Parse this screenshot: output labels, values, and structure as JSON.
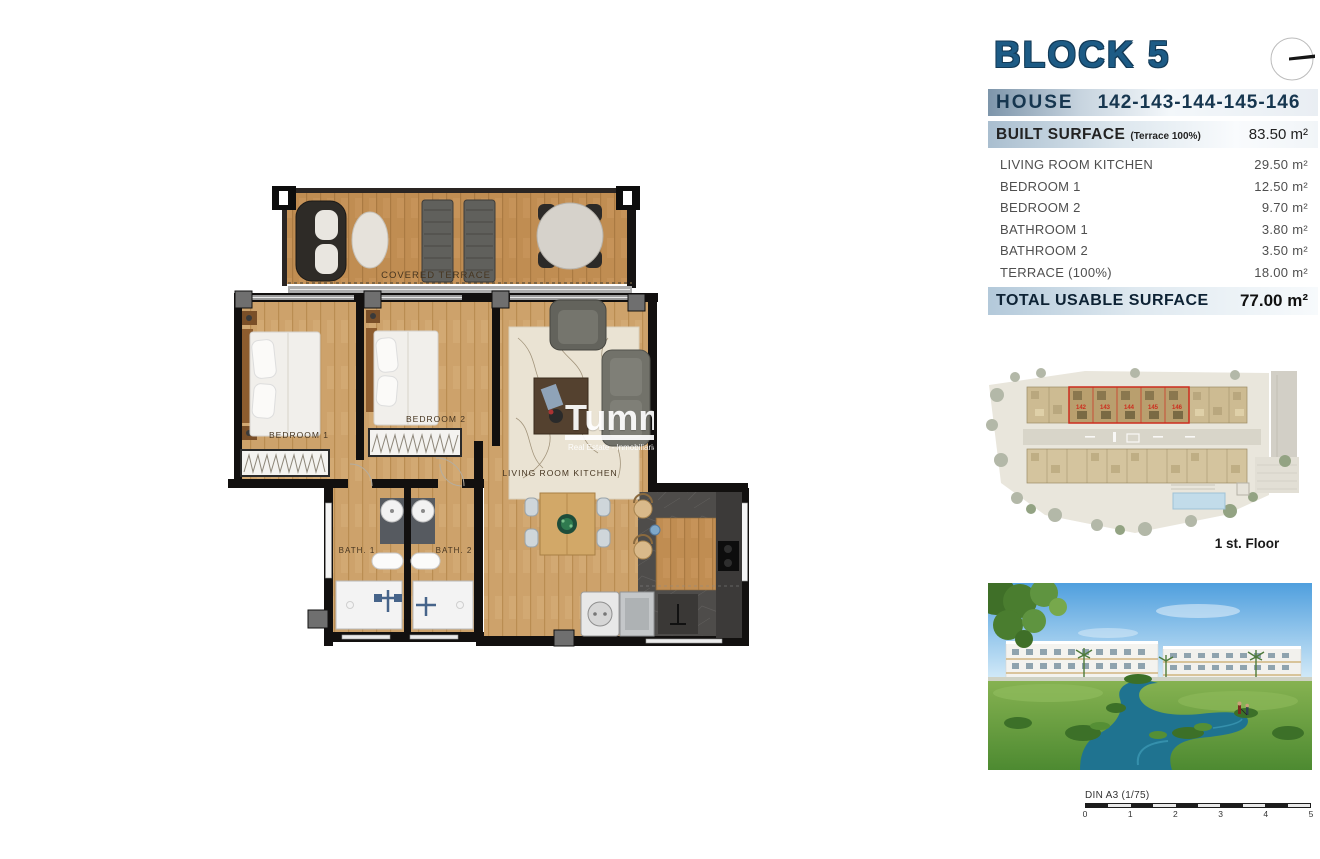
{
  "header": {
    "block_title": "BLOCK 5",
    "house_label": "HOUSE",
    "house_numbers": "142-143-144-145-146"
  },
  "surface_table": {
    "built_label": "BUILT SURFACE",
    "built_note": "(Terrace 100%)",
    "built_value": "83.50 m²",
    "rows": [
      {
        "label": "LIVING ROOM KITCHEN",
        "value": "29.50 m²"
      },
      {
        "label": "BEDROOM 1",
        "value": "12.50 m²"
      },
      {
        "label": "BEDROOM 2",
        "value": "9.70 m²"
      },
      {
        "label": "BATHROOM 1",
        "value": "3.80 m²"
      },
      {
        "label": "BATHROOM 2",
        "value": "3.50 m²"
      },
      {
        "label": "TERRACE (100%)",
        "value": "18.00 m²"
      }
    ],
    "total_label": "TOTAL USABLE SURFACE",
    "total_value": "77.00 m²"
  },
  "floor_plan": {
    "labels": {
      "covered_terrace": "COVERED TERRACE",
      "bedroom1": "BEDROOM 1",
      "bedroom2": "BEDROOM 2",
      "living": "LIVING ROOM KITCHEN",
      "bath1": "BATH. 1",
      "bath2": "BATH. 2"
    },
    "watermark": {
      "brand": "Tumme",
      "subtitle": "Real Estate - Inmobiliaria"
    }
  },
  "site_plan": {
    "caption": "1 st. Floor",
    "unit_numbers": [
      "142",
      "143",
      "144",
      "145",
      "146"
    ],
    "highlight_color": "#cc2d1e"
  },
  "scale_bar": {
    "label": "DIN A3 (1/75)",
    "ticks": [
      "0",
      "1",
      "2",
      "3",
      "4",
      "5"
    ]
  },
  "colors": {
    "title_blue": "#1d5b85",
    "band_slate": "#7d95aa",
    "wood": "#cda26b",
    "wood_dark": "#c08d52",
    "wall_black": "#12100f",
    "marble": "#4e4c4a"
  }
}
